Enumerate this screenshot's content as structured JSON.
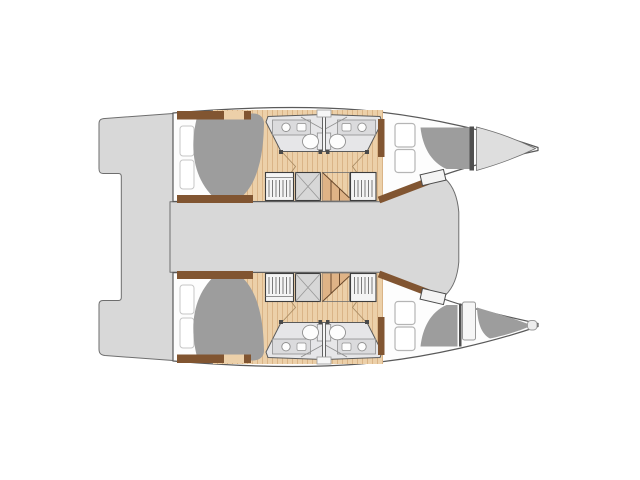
{
  "diagram": {
    "type": "catamaran-floor-plan",
    "view": "top-down"
  },
  "features": {
    "hull_count": 2,
    "double_cabin_count": 4,
    "bathroom_count": 4,
    "wardrobe_count": 4,
    "stairwell_count": 2,
    "skipper_berth_count": 1,
    "bed_count": 5,
    "sink_count": 4,
    "toilet_count": 4
  },
  "palette": {
    "background": "#ffffff",
    "deck_gray": "#d8d8d8",
    "bow_deck": "#dedede",
    "outline": "#5a5a5a",
    "outline_soft": "#6e6e6e",
    "hull_white": "#fdfdfd",
    "wood": "#ecd0a9",
    "wood_grain": "#d8b183",
    "wood_dark": "#dfb386",
    "wall_brown": "#815531",
    "stair_brown": "#6b4a2d",
    "bed_gray": "#9d9d9d",
    "bath_floor": "#e6e6e8",
    "counter_gray": "#dbdbdd",
    "fixture_white": "#fdfdfd",
    "fixture_stroke": "#8f8f8f",
    "tank_gray": "#ececee",
    "wardrobe_bg": "#f4f4f4",
    "wardrobe_stroke": "#3d3d3d",
    "hanger_lines": "#6e6e6e",
    "stair_box": "#d7d7d7",
    "x_lines": "#9b9b9b",
    "bulkhead_dark": "#4f4f4f",
    "cushion_white": "#ffffff",
    "cushion_stroke": "#b5b5b5",
    "pillow_stroke": "#c6c6c6",
    "sheet_fold": "#cfcfcf",
    "door_swing": "#a98b63",
    "tick_dark": "#4a4a4a",
    "hatch_fill": "#f6f6f6",
    "hatch_stroke": "#999999",
    "nub_fill": "#ededed"
  }
}
